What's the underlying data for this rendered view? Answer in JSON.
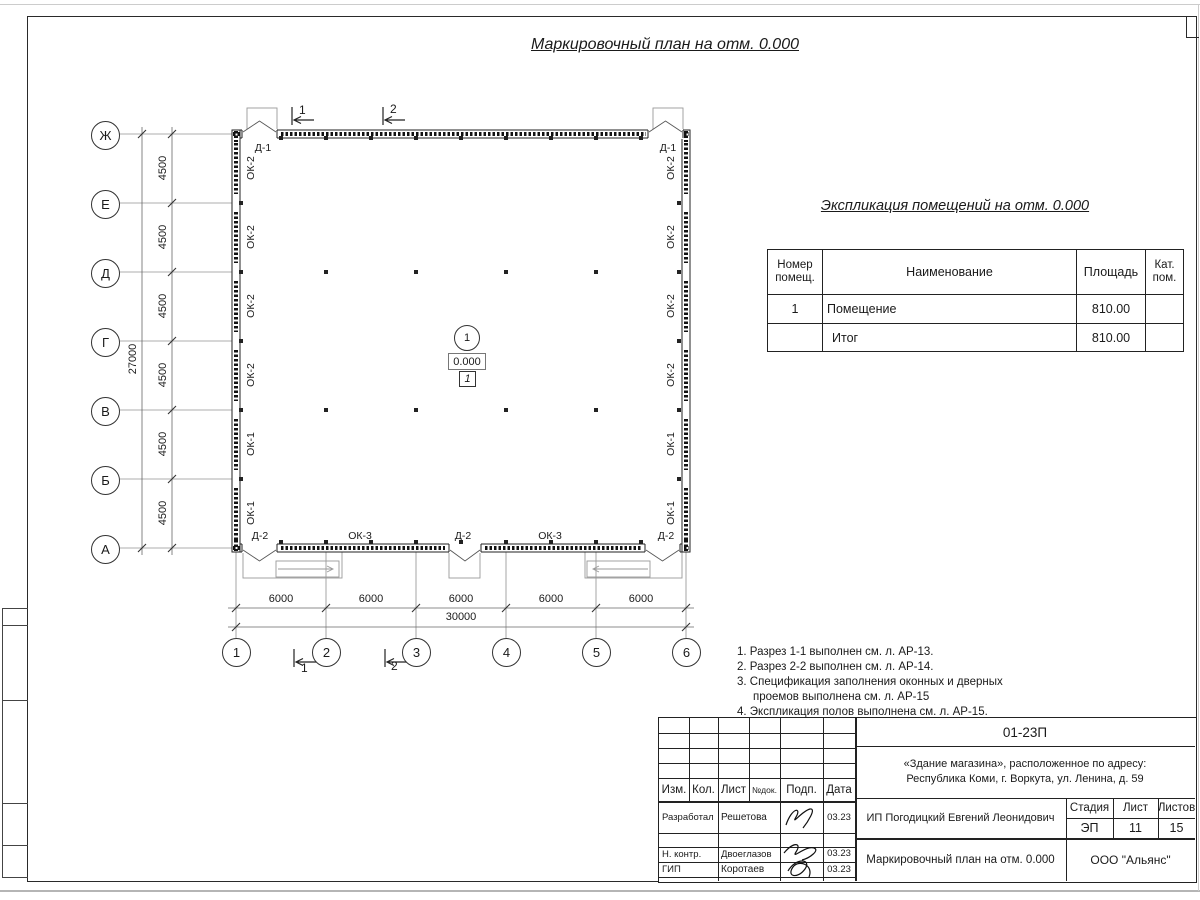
{
  "page": {
    "title": "Маркировочный план на отм. 0.000"
  },
  "plan": {
    "axis_rows": [
      "Ж",
      "Е",
      "Д",
      "Г",
      "В",
      "Б",
      "А"
    ],
    "axis_cols": [
      "1",
      "2",
      "3",
      "4",
      "5",
      "6"
    ],
    "dims_left": [
      "4500",
      "4500",
      "4500",
      "4500",
      "4500",
      "4500"
    ],
    "dim_left_total": "27000",
    "dims_bottom": [
      "6000",
      "6000",
      "6000",
      "6000",
      "6000"
    ],
    "dim_bottom_total": "30000",
    "windows_left": [
      "ОК-2",
      "ОК-2",
      "ОК-2",
      "ОК-2",
      "ОК-1",
      "ОК-1"
    ],
    "windows_right": [
      "ОК-2",
      "ОК-2",
      "ОК-2",
      "ОК-2",
      "ОК-1",
      "ОК-1"
    ],
    "windows_bottom": [
      "ОК-3",
      "ОК-3"
    ],
    "doors_top": [
      "Д-1",
      "Д-1"
    ],
    "doors_bottom": [
      "Д-2",
      "Д-2",
      "Д-2"
    ],
    "section_top": [
      "1",
      "2"
    ],
    "section_bottom": [
      "1",
      "2"
    ],
    "room_bubble": "1",
    "level_mark": "0.000",
    "floor_mark": "1"
  },
  "explication": {
    "title": "Экспликация помещений на отм. 0.000",
    "headers": {
      "number_line1": "Номер",
      "number_line2": "помещ.",
      "name": "Наименование",
      "area": "Площадь",
      "cat_line1": "Кат.",
      "cat_line2": "пом."
    },
    "rows": [
      {
        "number": "1",
        "name": "Помещение",
        "area": "810.00",
        "category": ""
      },
      {
        "number": "",
        "name": "Итог",
        "area": "810.00",
        "category": ""
      }
    ]
  },
  "notes": [
    "1. Разрез 1-1 выполнен см. л. АР-13.",
    "2. Разрез 2-2 выполнен см. л. АР-14.",
    "3. Спецификация заполнения оконных и дверных проемов выполнена см. л. АР-15",
    "4. Экспликация полов выполнена см. л. АР-15."
  ],
  "title_block": {
    "doc_number": "01-23П",
    "object_line1": "«Здание магазина», расположенное по адресу:",
    "object_line2": "Республика Коми, г. Воркута, ул. Ленина, д. 59",
    "cols": {
      "izm": "Изм.",
      "kol": "Кол.",
      "list": "Лист",
      "ndok": "№док.",
      "podp": "Подп.",
      "data": "Дата"
    },
    "roles": [
      {
        "role": "Разработал",
        "name": "Решетова",
        "date": "03.23"
      },
      {
        "role": "Н. контр.",
        "name": "Двоеглазов",
        "date": "03.23"
      },
      {
        "role": "ГИП",
        "name": "Коротаев",
        "date": "03.23"
      }
    ],
    "client": "ИП Погодицкий Евгений Леонидович",
    "stage_label": "Стадия",
    "sheet_label": "Лист",
    "sheets_label": "Листов",
    "stage": "ЭП",
    "sheet": "11",
    "sheets": "15",
    "doc_title": "Маркировочный план на отм. 0.000",
    "company": "ООО \"Альянс\""
  }
}
